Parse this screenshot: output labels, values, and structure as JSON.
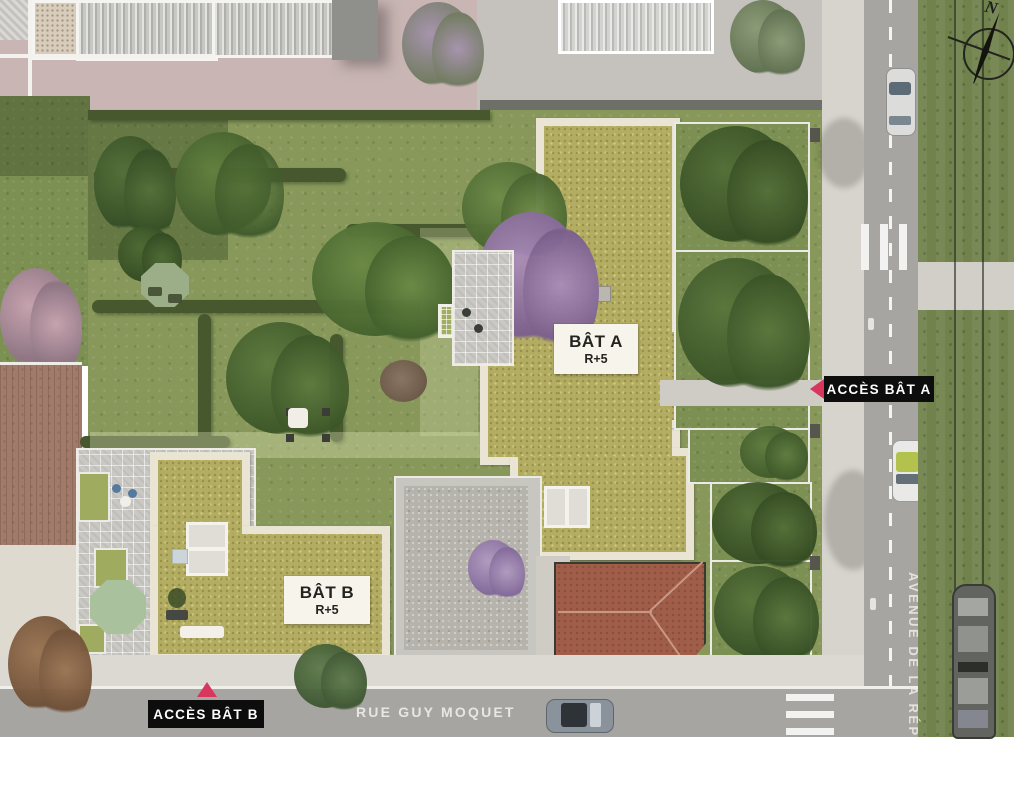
{
  "site_plan": {
    "compass": {
      "letter": "N"
    },
    "buildings": [
      {
        "name": "BÂT A",
        "floors": "R+5"
      },
      {
        "name": "BÂT B",
        "floors": "R+5"
      }
    ],
    "access_points": [
      {
        "label": "ACCÈS BÂT A",
        "direction": "left"
      },
      {
        "label": "ACCÈS BÂT B",
        "direction": "up"
      }
    ],
    "streets": [
      {
        "name": "RUE GUY MOQUET",
        "orientation": "horizontal"
      },
      {
        "name": "AVENUE DE LA RÉPUB",
        "orientation": "vertical"
      }
    ],
    "colors": {
      "site_grass": "#87985a",
      "green_roof": "#b3ac63",
      "parapet": "#e9e4d3",
      "terracotta_roof": "#a05d49",
      "road": "#a7a5a1",
      "sidewalk": "#d7d4ce",
      "tram_lawn": "#71824c",
      "paving_pink": "#c9b6b4",
      "accent_red": "#d9365e",
      "label_background": "#0d0d0d"
    }
  }
}
